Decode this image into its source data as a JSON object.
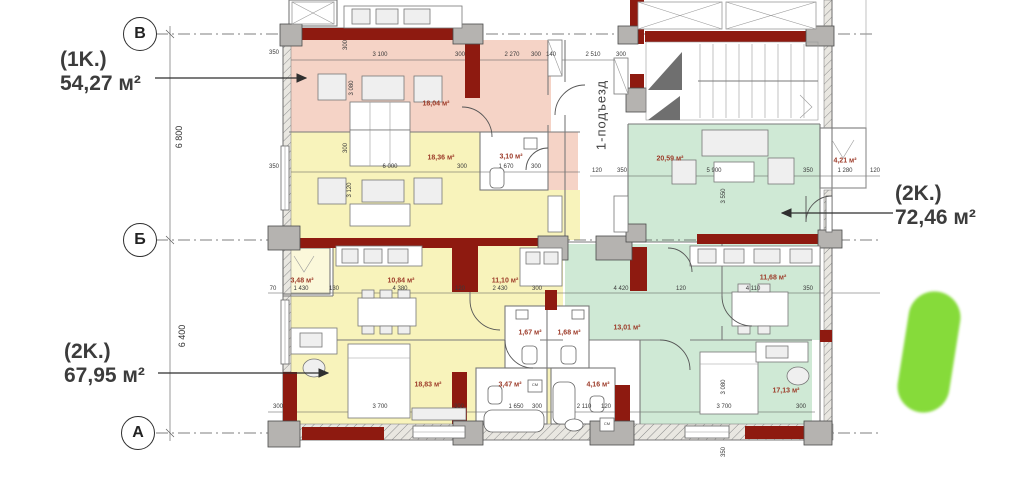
{
  "colors": {
    "pink": "#f5d3c6",
    "yellow": "#f8f3bb",
    "paleyellow": "#fbf8da",
    "green": "#cfe9d5",
    "wall": "#8e1a10",
    "maroon": "#9c3a28",
    "marker": "#7cd82a"
  },
  "axes": {
    "row_v": "В",
    "row_b": "Б",
    "row_a": "А",
    "dim_vb": "6 800",
    "dim_ba": "6 400"
  },
  "entrance_label": "1-подъезд",
  "apartments": {
    "apt_1k": {
      "type": "(1K.)",
      "area": "54,27 м²"
    },
    "apt_2k_left": {
      "type": "(2K.)",
      "area": "67,95 м²"
    },
    "apt_2k_right": {
      "type": "(2K.)",
      "area": "72,46 м²"
    }
  },
  "room_labels": [
    {
      "t": "18,04 м²",
      "x": 436,
      "y": 104
    },
    {
      "t": "18,36 м²",
      "x": 441,
      "y": 158
    },
    {
      "t": "3,10 м²",
      "x": 511,
      "y": 157
    },
    {
      "t": "20,59 м²",
      "x": 670,
      "y": 159
    },
    {
      "t": "4,21 м²",
      "x": 845,
      "y": 161
    },
    {
      "t": "3,48 м²",
      "x": 302,
      "y": 281
    },
    {
      "t": "10,84 м²",
      "x": 401,
      "y": 281
    },
    {
      "t": "11,10 м²",
      "x": 505,
      "y": 281
    },
    {
      "t": "11,68 м²",
      "x": 773,
      "y": 278
    },
    {
      "t": "1,67 м²",
      "x": 530,
      "y": 333
    },
    {
      "t": "1,68 м²",
      "x": 569,
      "y": 333
    },
    {
      "t": "13,01 м²",
      "x": 627,
      "y": 328
    },
    {
      "t": "3,47 м²",
      "x": 510,
      "y": 385
    },
    {
      "t": "4,16 м²",
      "x": 598,
      "y": 385
    },
    {
      "t": "18,83 м²",
      "x": 428,
      "y": 385
    },
    {
      "t": "17,13 м²",
      "x": 786,
      "y": 391
    }
  ],
  "dims": [
    {
      "t": "350",
      "x": 274,
      "y": 53
    },
    {
      "t": "3 100",
      "x": 380,
      "y": 55
    },
    {
      "t": "300",
      "x": 460,
      "y": 55
    },
    {
      "t": "2 270",
      "x": 512,
      "y": 55
    },
    {
      "t": "300",
      "x": 536,
      "y": 55
    },
    {
      "t": "140",
      "x": 551,
      "y": 55
    },
    {
      "t": "2 510",
      "x": 593,
      "y": 55
    },
    {
      "t": "300",
      "x": 621,
      "y": 55
    },
    {
      "t": "350",
      "x": 274,
      "y": 167
    },
    {
      "t": "6 000",
      "x": 390,
      "y": 167
    },
    {
      "t": "300",
      "x": 462,
      "y": 167
    },
    {
      "t": "1 670",
      "x": 506,
      "y": 167
    },
    {
      "t": "300",
      "x": 536,
      "y": 167
    },
    {
      "t": "120",
      "x": 597,
      "y": 171
    },
    {
      "t": "350",
      "x": 622,
      "y": 171
    },
    {
      "t": "5 900",
      "x": 714,
      "y": 171
    },
    {
      "t": "350",
      "x": 808,
      "y": 171
    },
    {
      "t": "1 280",
      "x": 845,
      "y": 171
    },
    {
      "t": "120",
      "x": 875,
      "y": 171
    },
    {
      "t": "70",
      "x": 273,
      "y": 289
    },
    {
      "t": "1 430",
      "x": 301,
      "y": 289
    },
    {
      "t": "130",
      "x": 334,
      "y": 289
    },
    {
      "t": "4 380",
      "x": 400,
      "y": 289
    },
    {
      "t": "120",
      "x": 460,
      "y": 289
    },
    {
      "t": "2 430",
      "x": 500,
      "y": 289
    },
    {
      "t": "300",
      "x": 537,
      "y": 289
    },
    {
      "t": "4 420",
      "x": 621,
      "y": 289
    },
    {
      "t": "120",
      "x": 681,
      "y": 289
    },
    {
      "t": "4 110",
      "x": 753,
      "y": 289
    },
    {
      "t": "350",
      "x": 808,
      "y": 289
    },
    {
      "t": "300",
      "x": 278,
      "y": 407
    },
    {
      "t": "3 700",
      "x": 380,
      "y": 407
    },
    {
      "t": "300",
      "x": 459,
      "y": 407
    },
    {
      "t": "1 650",
      "x": 516,
      "y": 407
    },
    {
      "t": "300",
      "x": 537,
      "y": 407
    },
    {
      "t": "2 110",
      "x": 584,
      "y": 407
    },
    {
      "t": "120",
      "x": 606,
      "y": 407
    },
    {
      "t": "3 700",
      "x": 724,
      "y": 407
    },
    {
      "t": "300",
      "x": 801,
      "y": 407
    },
    {
      "t": "3 080",
      "x": 352,
      "y": 88,
      "r": 1
    },
    {
      "t": "3 120",
      "x": 350,
      "y": 190,
      "r": 1
    },
    {
      "t": "3 550",
      "x": 724,
      "y": 196,
      "r": 1
    },
    {
      "t": "3 080",
      "x": 724,
      "y": 387,
      "r": 1
    },
    {
      "t": "300",
      "x": 346,
      "y": 45,
      "r": 1
    },
    {
      "t": "300",
      "x": 346,
      "y": 148,
      "r": 1
    },
    {
      "t": "350",
      "x": 724,
      "y": 452,
      "r": 1
    },
    {
      "t": "СМ",
      "x": 535,
      "y": 385,
      "fs": 4
    },
    {
      "t": "СМ",
      "x": 607,
      "y": 424,
      "fs": 4
    }
  ]
}
